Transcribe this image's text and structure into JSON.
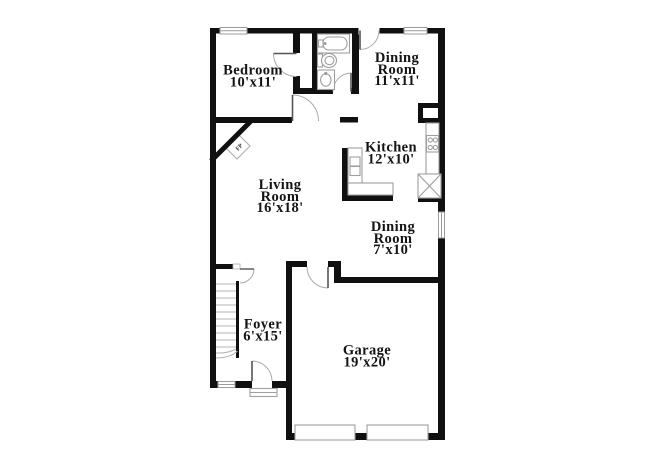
{
  "page": {
    "background": "#ffffff",
    "wall_color": "#101010",
    "fixture_color": "#9f9f9f",
    "label_color": "#141414"
  },
  "floorplan": {
    "type": "single-family-home-first-floor",
    "rooms": [
      {
        "id": "bedroom",
        "name": "Bedroom",
        "dims": "10'x11'"
      },
      {
        "id": "dining-room-upper",
        "name": "Dining\nRoom",
        "dims": "11'x11'"
      },
      {
        "id": "kitchen",
        "name": "Kitchen",
        "dims": "12'x10'"
      },
      {
        "id": "living-room",
        "name": "Living\nRoom",
        "dims": "16'x18'"
      },
      {
        "id": "dining-room-lower",
        "name": "Dining\nRoom",
        "dims": "7'x10'"
      },
      {
        "id": "foyer",
        "name": "Foyer",
        "dims": "6'x15'"
      },
      {
        "id": "garage",
        "name": "Garage",
        "dims": "19'x20'"
      }
    ],
    "fireplace_label": "FP"
  }
}
